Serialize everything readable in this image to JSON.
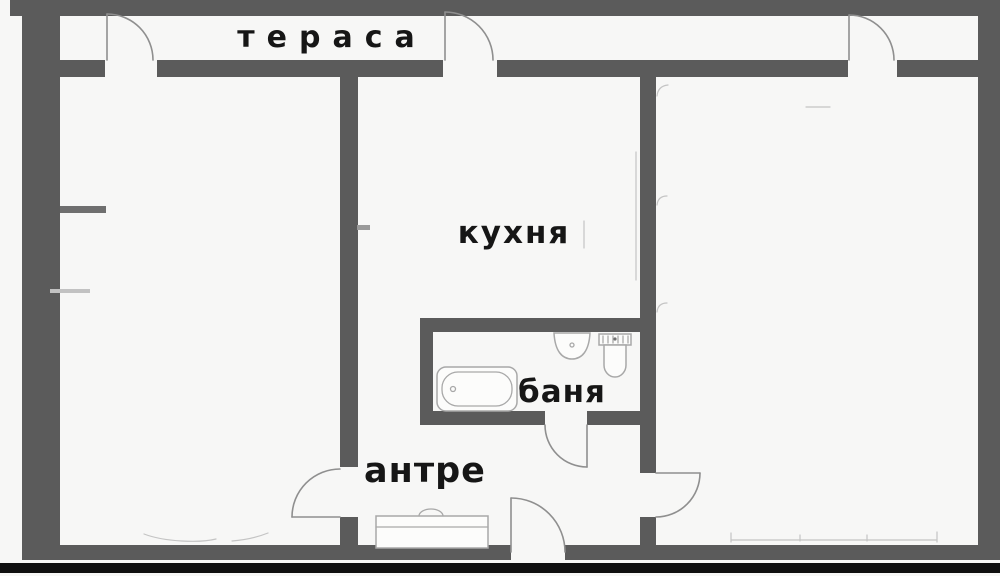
{
  "page": {
    "type": "apartment-floor-plan",
    "language": "bulgarian"
  },
  "rooms": [
    {
      "name": "terrace",
      "label": "тераса"
    },
    {
      "name": "kitchen",
      "label": "кухня"
    },
    {
      "name": "bathroom",
      "label": "баня"
    },
    {
      "name": "hallway",
      "label": "антре"
    }
  ],
  "fixtures": [
    "bathtub-icon",
    "sink-icon",
    "toilet-icon",
    "wardrobe-icon",
    "radiator-icon",
    "door-swing-icon"
  ],
  "door_count": 7,
  "colors": {
    "background": "#f7f7f6",
    "wall": "#5b5b5b",
    "door_line": "#8f8f8f",
    "fixture_line": "#a8a8a8",
    "label_text": "#161616",
    "bottom_bar": "#0f0f0f"
  }
}
